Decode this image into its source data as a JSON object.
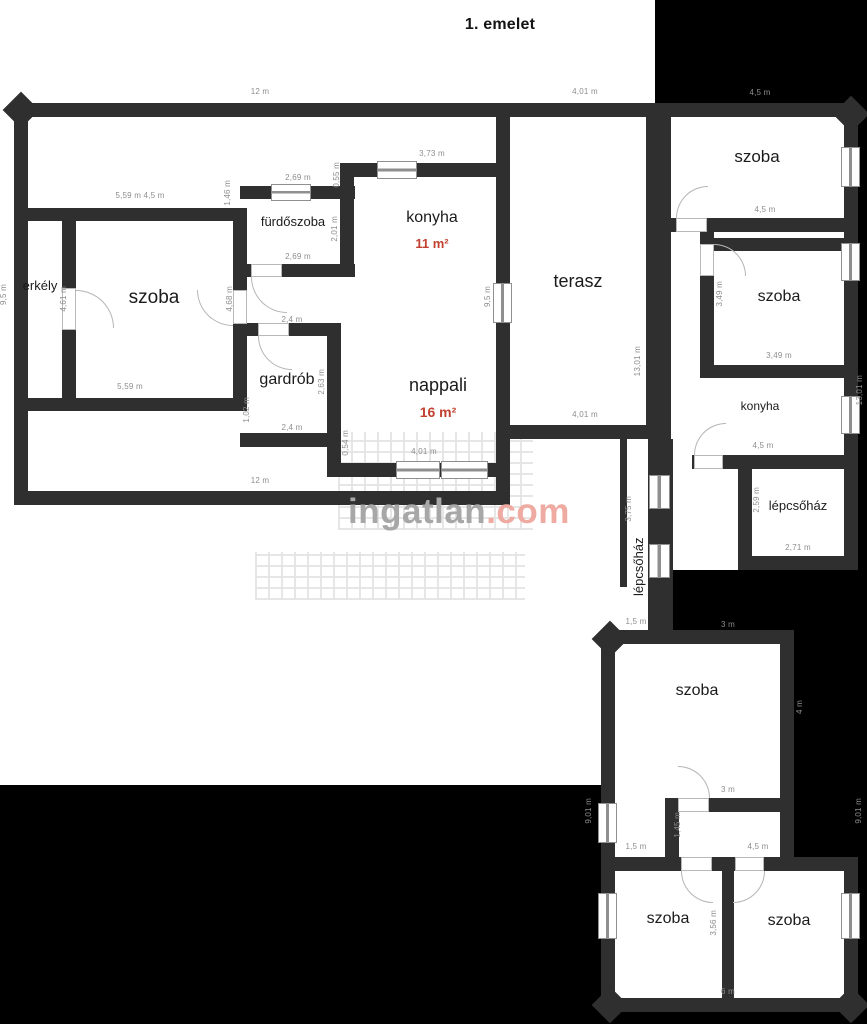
{
  "title": "1. emelet",
  "watermark": {
    "name": "ingatlan",
    "tld": ".com"
  },
  "colors": {
    "wall": "#2f2f2f",
    "background_mask": "#000000",
    "dimension_text": "#8d8d8d",
    "room_text": "#1b1b1b",
    "area_accent": "#c2402f",
    "watermark_gray": "#a7a7a7",
    "watermark_red": "#efaaa2"
  },
  "rooms": {
    "szoba_main": "szoba",
    "erkely": "erkély",
    "furdoszoba": "fürdőszoba",
    "konyha": "konyha",
    "gardrob": "gardrób",
    "nappali": "nappali",
    "terasz": "terasz",
    "szoba_r1": "szoba",
    "szoba_r2": "szoba",
    "konyha_r": "konyha",
    "lepcsohaz_r": "lépcsőház",
    "lepcsohaz_n": "lépcsőház",
    "szoba_mid": "szoba",
    "szoba_b1": "szoba",
    "szoba_b2": "szoba"
  },
  "areas": {
    "konyha": "11 m²",
    "nappali": "16 m²"
  },
  "dims": {
    "top_12": "12 m",
    "top_401": "4,01 m",
    "top_45": "4,5 m",
    "szoba_top": "5,59 m 4,5 m",
    "furdo_top": "2,69 m",
    "konyha_top": "3,73 m",
    "v_055": "0,55 m",
    "v_146": "1,46 m",
    "v_201": "2,01 m",
    "furdo_bottom": "2,69 m",
    "v_468": "4,68 m",
    "v_461": "4,61 m",
    "v_95_left": "9,5 m",
    "v_95_right": "9,5 m",
    "szoba_bottom": "5,59 m",
    "gardrob_top": "2,4 m",
    "v_263": "2,63 m",
    "v_102": "1,02 m",
    "gardrob_bottom": "2,4 m",
    "v_054": "0,54 m",
    "nappali_bottom": "4,01 m",
    "bottom_12": "12 m",
    "v_1301_terasz": "13,01 m",
    "terasz_bottom": "4,01 m",
    "szoba_r1_bottom": "4,5 m",
    "v_349": "3,49 m",
    "szoba_r2_bottom": "3,49 m",
    "konyha_r_bottom": "4,5 m",
    "v_259": "2,59 m",
    "lepcso_r_bottom": "2,71 m",
    "v_375": "3,75 m",
    "corridor_15": "1,5 m",
    "mid_top_3": "3 m",
    "v_4": "4 m",
    "mid_bottom_3": "3 m",
    "v_145": "1,45 m",
    "mid_15": "1,5 m",
    "mid_45": "4,5 m",
    "v_901_left": "9,01 m",
    "v_901_right": "9,01 m",
    "v_1301_right": "13,01 m",
    "v_356": "3,56 m",
    "bottom_6": "6 m"
  }
}
